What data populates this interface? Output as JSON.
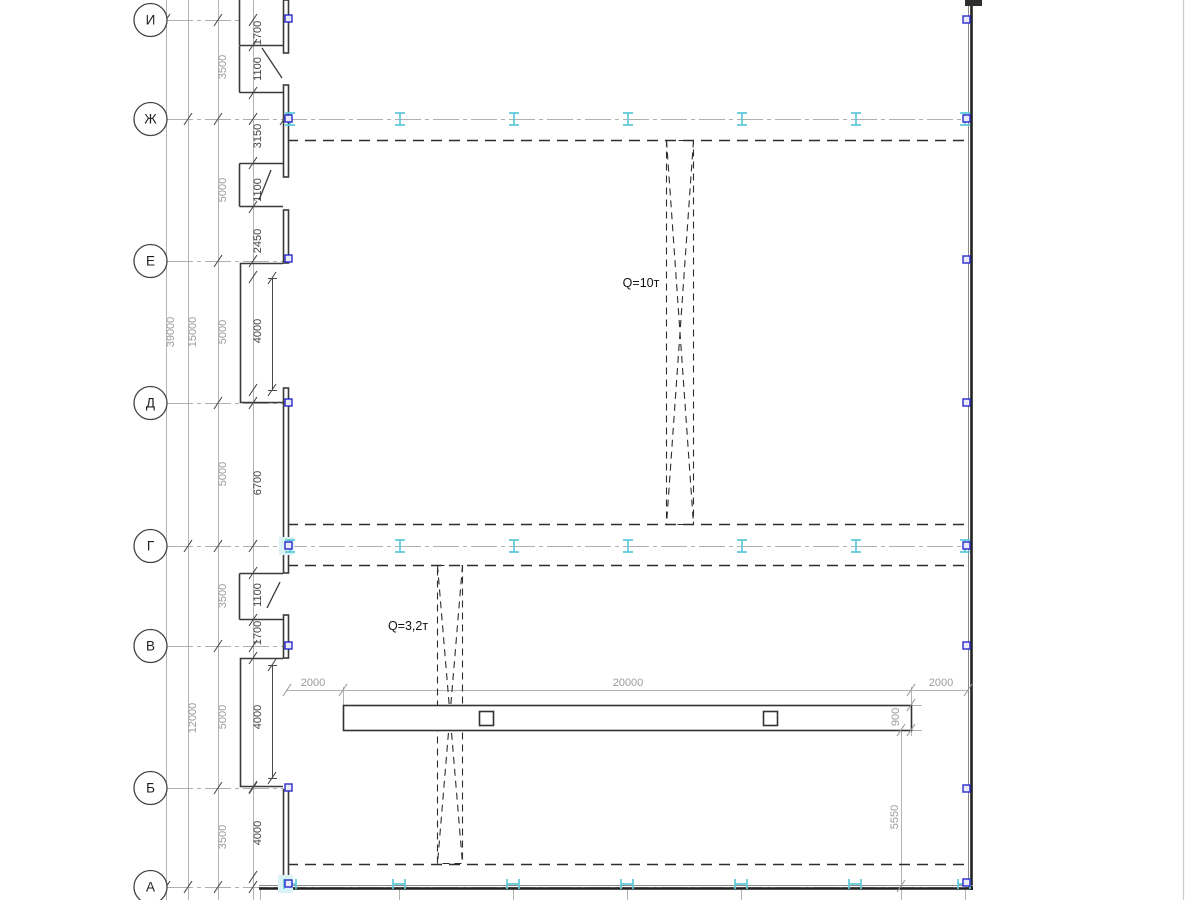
{
  "drawing": {
    "type": "structural-plan-crane-layout",
    "axes": {
      "rows": [
        {
          "label": "И"
        },
        {
          "label": "Ж"
        },
        {
          "label": "Е"
        },
        {
          "label": "Д"
        },
        {
          "label": "Г"
        },
        {
          "label": "В"
        },
        {
          "label": "Б"
        },
        {
          "label": "А"
        }
      ]
    },
    "cranes": [
      {
        "label": "Q=10т"
      },
      {
        "label": "Q=3,2т"
      }
    ],
    "dimensions": {
      "total": "39000",
      "upper_group": "15000",
      "lower_group": "12000",
      "axis_spacings": [
        "3500",
        "5000",
        "5000",
        "5000",
        "3500",
        "5000",
        "3500"
      ],
      "wall_chain": [
        "1700",
        "1100",
        "3150",
        "1100",
        "2450",
        "4000",
        "6700",
        "1100",
        "1700",
        "4000",
        "4000"
      ],
      "beam_run": [
        "2000",
        "20000",
        "2000"
      ],
      "beam_width": "900",
      "beam_edge_offset": "5550"
    },
    "colors": {
      "construction_gray": "#b3b3b3",
      "dim_text_gray": "#9c9c9c",
      "dim_text_dark": "#424242",
      "wall_dark": "#3a3a3a",
      "dashed_dark": "#2d2d2d",
      "column_marker_blue": "#2a2ace",
      "rail_symbol_cyan": "#5fc9d9",
      "rail_highlight_cyan": "#d9f3f7"
    }
  }
}
